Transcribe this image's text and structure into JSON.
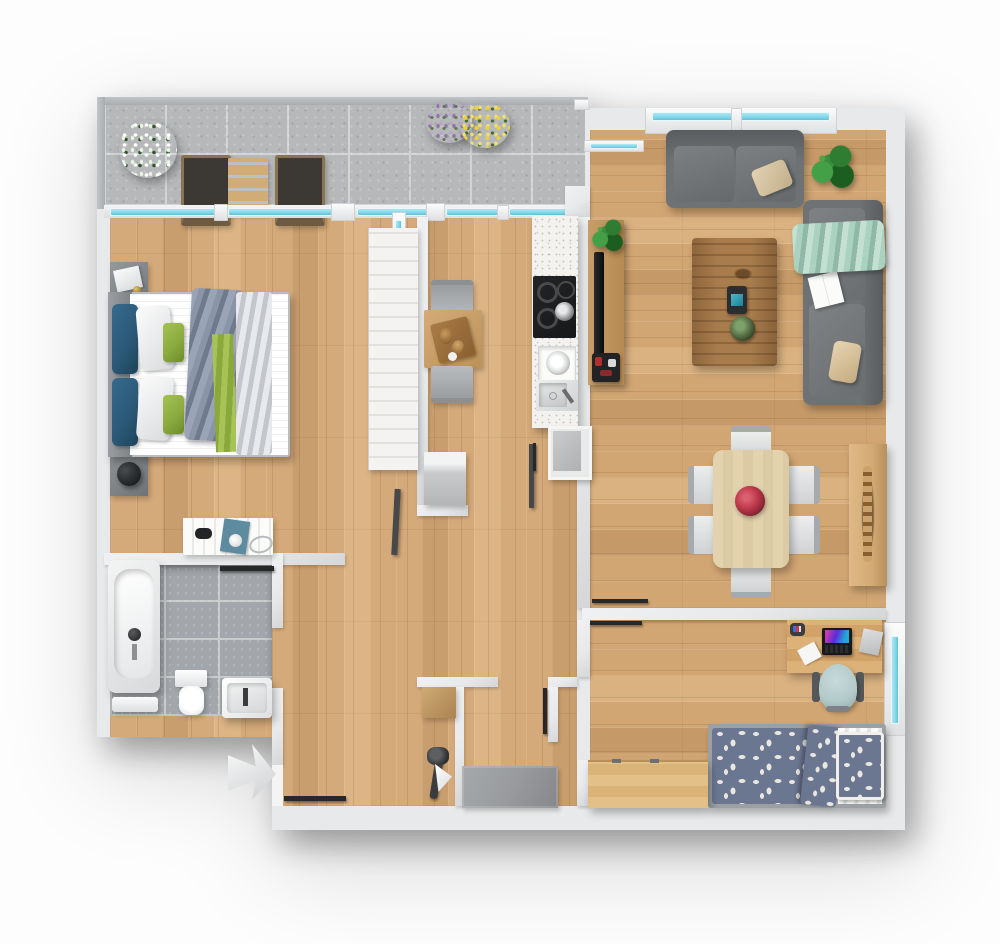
{
  "palette": {
    "wall": "#e8e9ea",
    "wall_shade": "#d4d6d8",
    "railing": "#a9adaf",
    "wood": "#d5aa7a",
    "wood_living": "#d2a673",
    "balcony_tile": "#b6b8ba",
    "balcony_grout": "#d2d4d5",
    "bath_tile": "#a3a6aa",
    "bath_grout": "#c9cbcd",
    "glass": "#82d7ea",
    "sofa": "#6e7274",
    "sofa_dark": "#595d5f",
    "mint": "#abd1c1",
    "plant": "#3f7d37",
    "plant_dark": "#27551f",
    "coffee_wood": "#a87c4c",
    "navy": "#2b5876",
    "green_pillow": "#8cab3f",
    "blanket": "#8b95a8",
    "sheet": "#dfe2e5",
    "counter": "#f3f2ef",
    "stove": "#17181a",
    "steel": "#c9cbcd",
    "dining_wood": "#dccaa5",
    "chair_gray": "#b9bcbe",
    "sideboard_wood": "#d2aa74",
    "desk_wood": "#d2a368",
    "chair_teal": "#b3cbca",
    "duvet": "#6b7691",
    "duvet_light": "#e9e7e0",
    "bench_wood": "#d9b377",
    "mat": "#97999c",
    "door_leaf": "#46484a",
    "rail_black": "#26282a",
    "flower_red": "#c23b4e"
  },
  "plan": {
    "type": "apartment-floor-plan-3d-top-view",
    "rooms": [
      {
        "name": "balcony",
        "floor": "gray-tile",
        "objects": [
          "flower-pot-white",
          "flower-pot-purple",
          "flower-pot-yellow",
          "armchair-left",
          "armchair-right",
          "slat-table",
          "railing",
          "window-band"
        ]
      },
      {
        "name": "bedroom",
        "floor": "light-wood",
        "objects": [
          "double-bed",
          "navy-pillows",
          "green-pillows",
          "blue-gray-blanket",
          "nightstand-top",
          "nightstand-lamp",
          "wardrobe",
          "dresser",
          "radiator",
          "door-leaf"
        ]
      },
      {
        "name": "bathroom",
        "floor": "gray-tile",
        "objects": [
          "bathtub",
          "tub-faucet",
          "bath-shelf",
          "toilet",
          "washbasin",
          "towel-rail"
        ]
      },
      {
        "name": "kitchen",
        "floor": "light-wood",
        "objects": [
          "counter",
          "cooktop",
          "pan",
          "dish-rack",
          "sink",
          "base-cabinet",
          "tall-cabinet",
          "breakfast-table",
          "bread-board",
          "chair-top",
          "chair-bottom",
          "door-leaf"
        ]
      },
      {
        "name": "living-room",
        "floor": "light-wood",
        "objects": [
          "sofa-top",
          "beige-pillow",
          "plant-large",
          "chaise-sofa",
          "mint-blanket",
          "open-book",
          "beige-pillow-2",
          "coffee-table",
          "remote",
          "plant-bowl",
          "tv-board",
          "tv",
          "plant-small",
          "game-console",
          "dining-table",
          "flower-vase",
          "dining-chairs-x6",
          "sideboard",
          "wall-rails",
          "radiator",
          "window-top"
        ]
      },
      {
        "name": "office-bedroom",
        "floor": "light-wood",
        "objects": [
          "desk",
          "laptop",
          "paper",
          "pen-cup",
          "notepad",
          "office-chair",
          "single-bed",
          "patterned-duvet",
          "patterned-pillow",
          "white-sheet",
          "wooden-bench",
          "window-right"
        ]
      },
      {
        "name": "hallway",
        "floor": "light-wood",
        "objects": [
          "entrance-arrow",
          "entrance-door-opening",
          "doormat",
          "coat-nook-cabinet",
          "umbrella-stand",
          "door-swing",
          "shoe-rail",
          "wall-rail"
        ]
      }
    ]
  }
}
